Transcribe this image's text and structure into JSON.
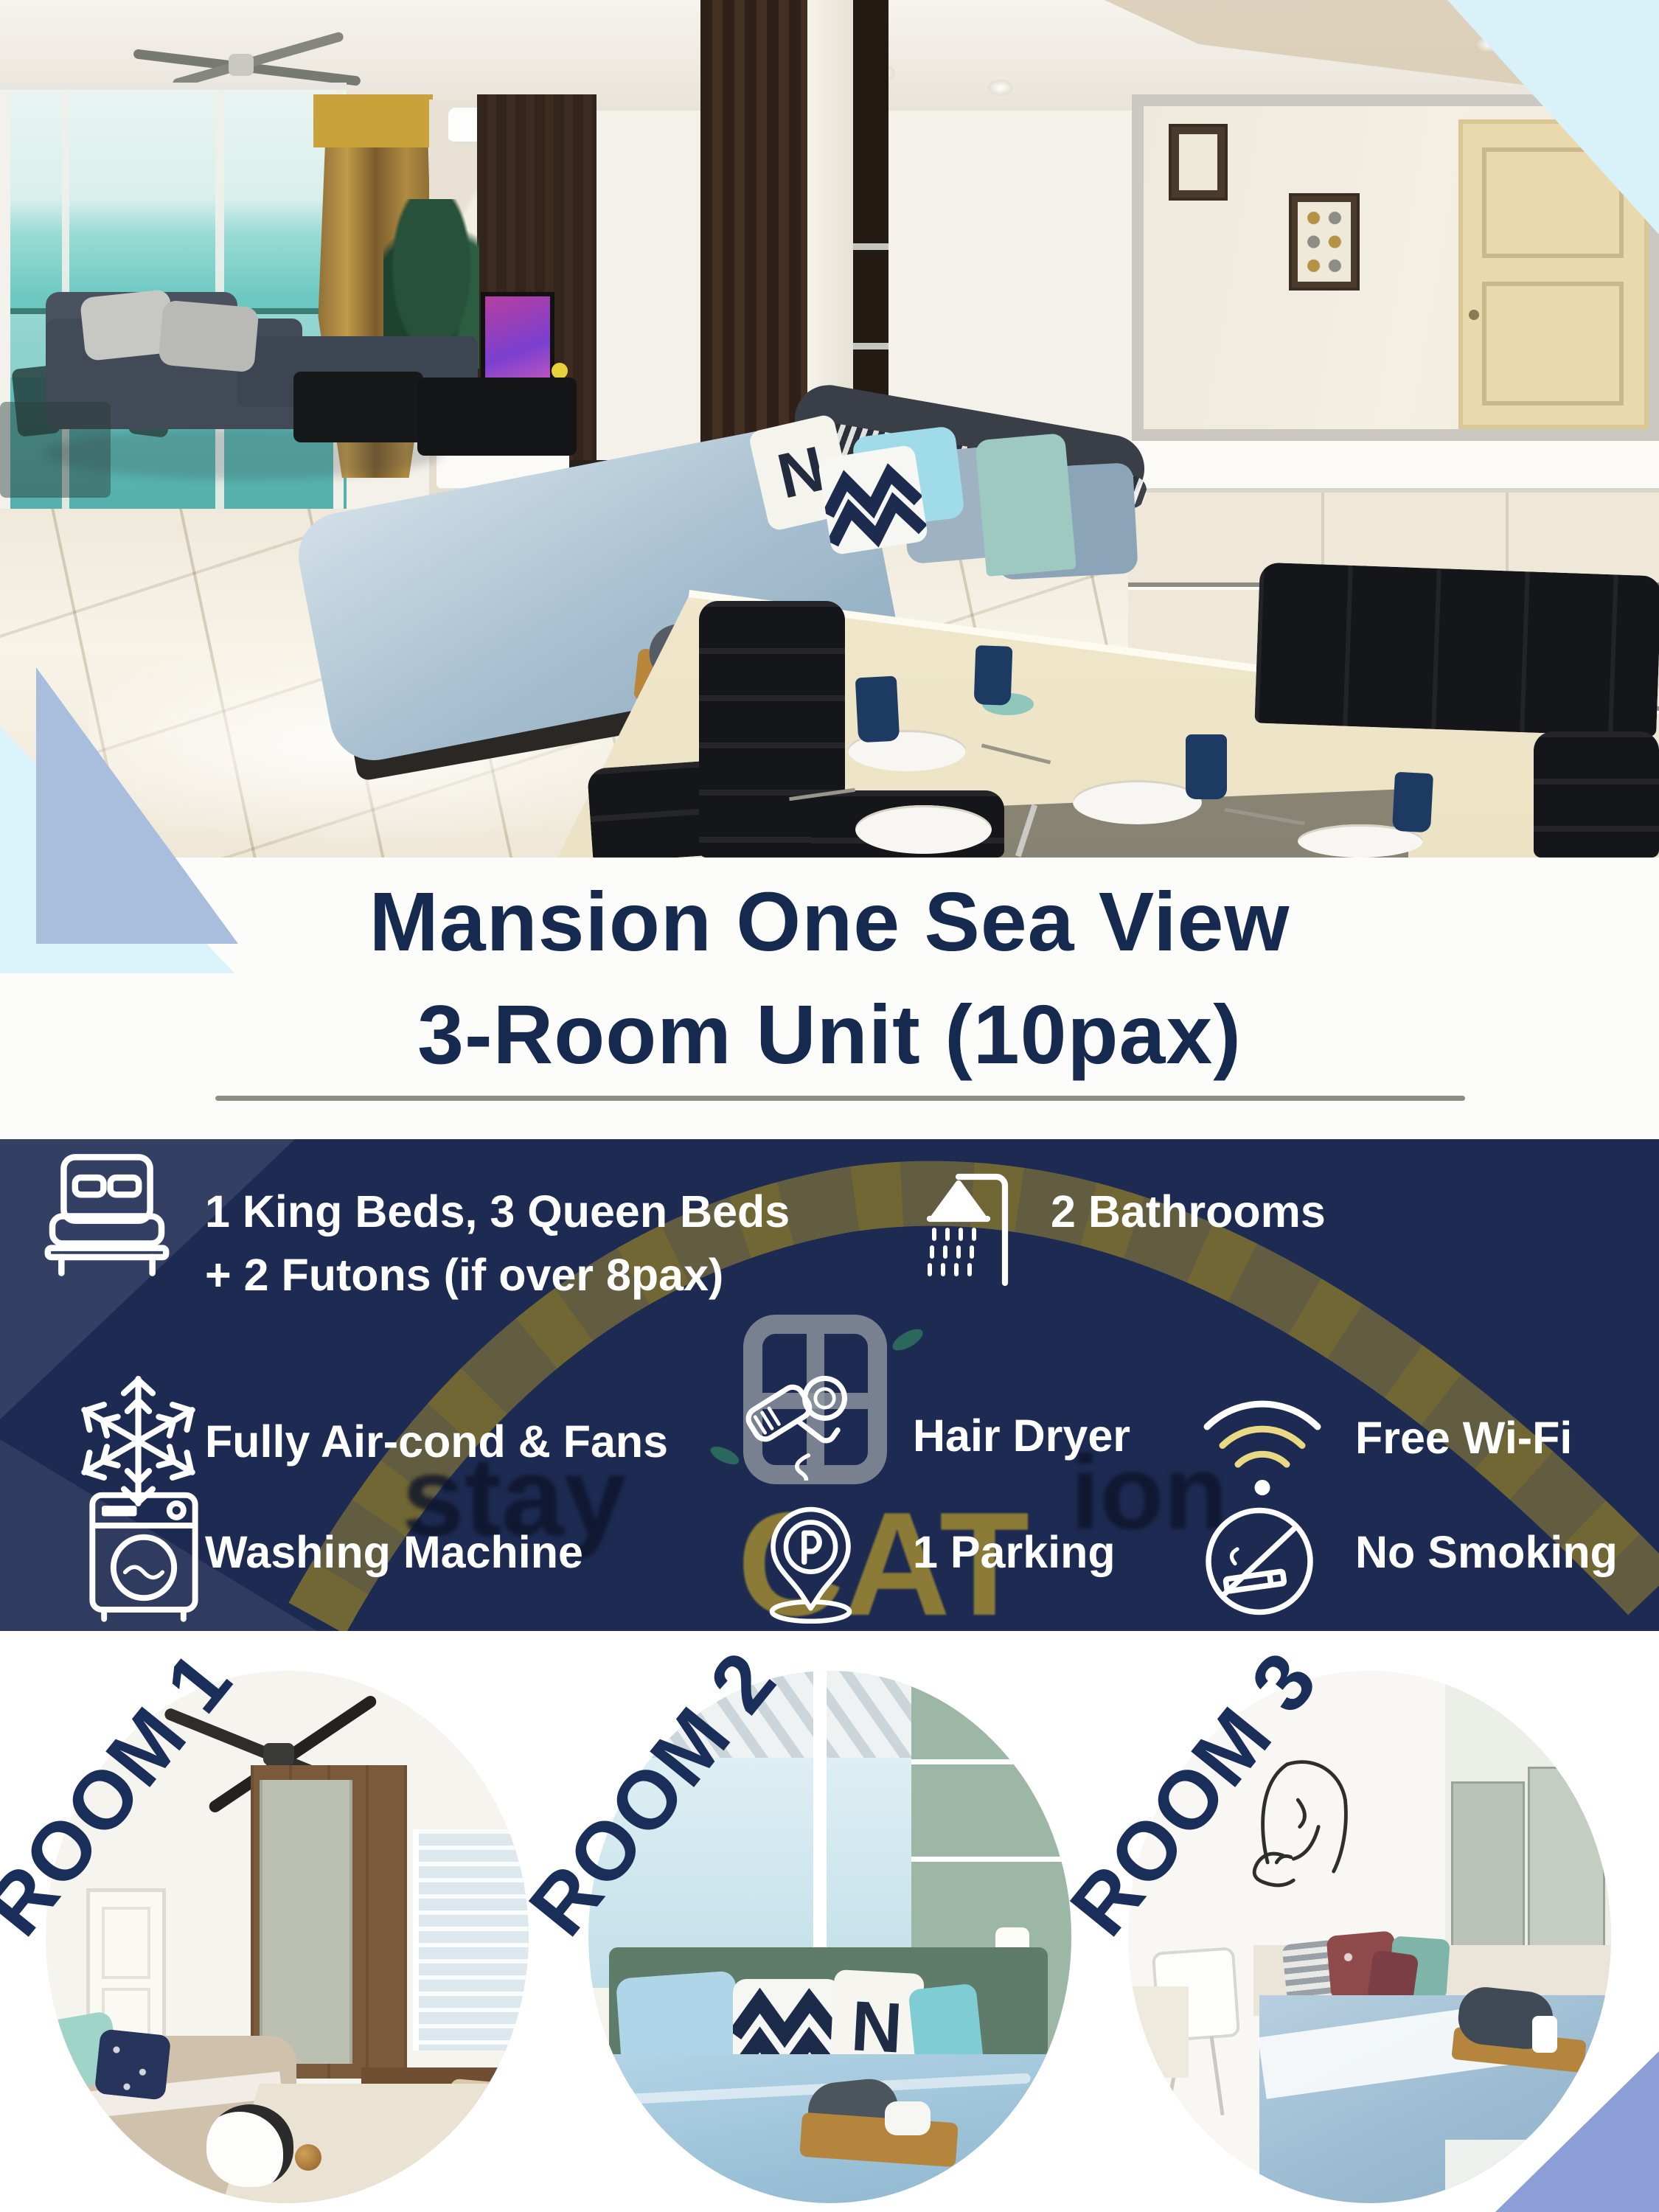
{
  "title": {
    "line1": "Mansion One Sea View",
    "line2": "3-Room Unit (10pax)"
  },
  "amenities": {
    "items": [
      {
        "icon": "bed-icon",
        "label": "1 King Beds, 3 Queen Beds",
        "label2": "+ 2 Futons (if over 8pax)"
      },
      {
        "icon": "shower-icon",
        "label": "2 Bathrooms"
      },
      {
        "icon": "snowflake-icon",
        "label": "Fully Air-cond & Fans"
      },
      {
        "icon": "hair-dryer-icon",
        "label": "Hair Dryer"
      },
      {
        "icon": "wifi-icon",
        "label": "Free Wi-Fi"
      },
      {
        "icon": "washing-machine-icon",
        "label": "Washing Machine"
      },
      {
        "icon": "parking-icon",
        "label": "1 Parking"
      },
      {
        "icon": "no-smoking-icon",
        "label": "No Smoking"
      }
    ]
  },
  "watermark": {
    "stay": "stay",
    "cat": "CAT",
    "ion": "ion"
  },
  "rooms": [
    {
      "label": "ROOM 1"
    },
    {
      "label": "ROOM 2"
    },
    {
      "label": "ROOM 3"
    }
  ],
  "photo": {
    "pillow_letter": "N"
  },
  "colors": {
    "navy_panel": "#1d2b52",
    "navy_text": "#16294f",
    "white": "#ffffff",
    "pale_cyan": "#d9f2f9",
    "steel_blue": "#a9bedc",
    "periwinkle": "#8c9ed6",
    "watermark_olive": "#ab8f2e",
    "divider_gray": "#8f8c82"
  }
}
